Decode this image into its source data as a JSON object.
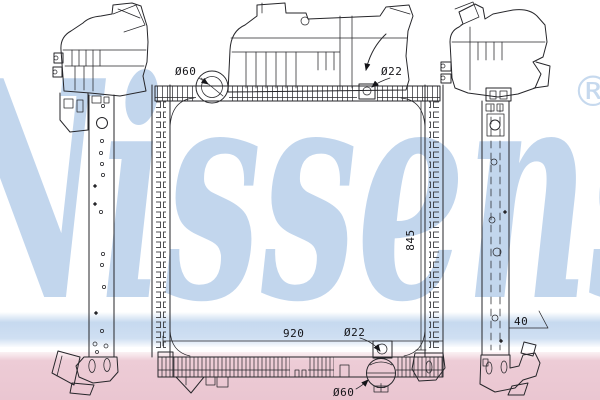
{
  "watermark": {
    "brand": "Nissens",
    "registered_mark": "®"
  },
  "colors": {
    "script_blue": "#aec9e8",
    "stripe_blue": "#c6d9ef",
    "stripe_pink": "#edccd6",
    "line_color": "#26262a",
    "background": "#ffffff"
  },
  "dimension_labels": {
    "top_left_port": "Ø60",
    "top_right_port": "Ø22",
    "core_height": "845",
    "core_width": "920",
    "bottom_outlet": "Ø22",
    "side_bracket_depth": "40",
    "bottom_drain": "Ø60"
  }
}
